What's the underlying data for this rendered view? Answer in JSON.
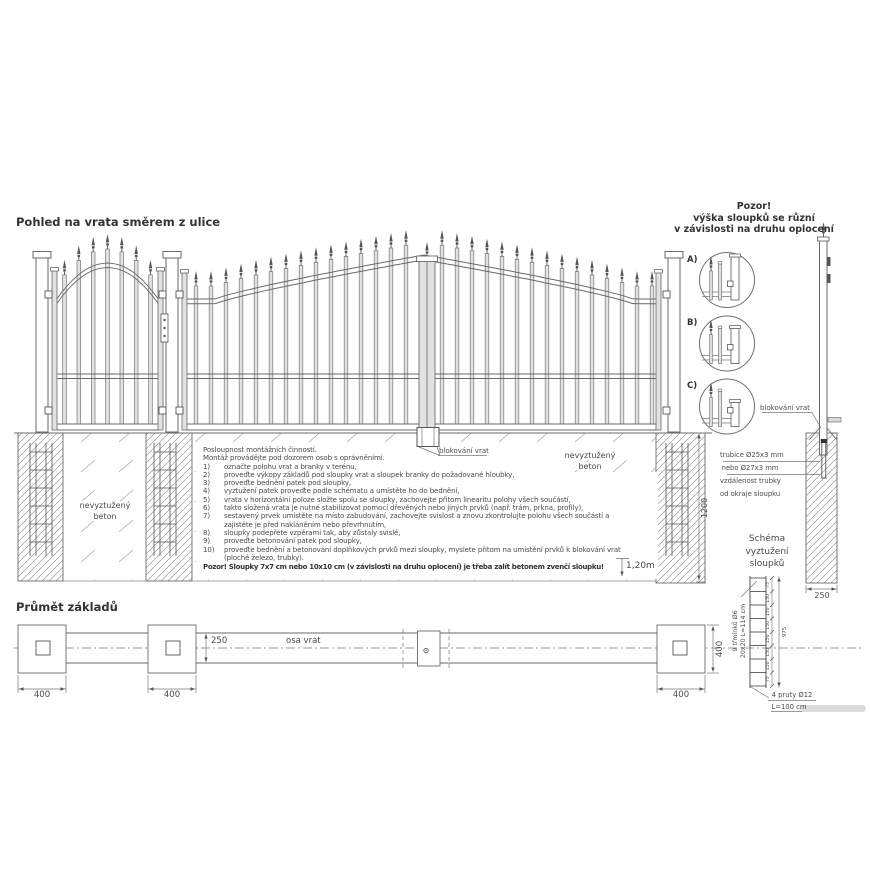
{
  "page": {
    "view_title": "Pohled na vrata směrem z ulice",
    "plan_title": "Průmět základů"
  },
  "notice_top_right": {
    "line1": "Pozor!",
    "line2": "výška sloupků se různí",
    "line3": "v závislosti na druhu oplocení"
  },
  "instructions": {
    "intro1": "Posloupnost montážních činností.",
    "intro2": "Montáž provádějte pod dozorem osob s oprávněními.",
    "steps": [
      {
        "num": "1)",
        "text": "označte polohu vrat a branky v terénu,"
      },
      {
        "num": "2)",
        "text": "proveďte výkopy základů pod sloupky vrat a sloupek branky do požadované hloubky,"
      },
      {
        "num": "3)",
        "text": "proveďte bednění patek pod sloupky,"
      },
      {
        "num": "4)",
        "text": "vyztužení patek proveďte podle schématu a umístěte ho do bednění,"
      },
      {
        "num": "5)",
        "text": "vrata v horizontální poloze složte spolu se sloupky, zachovejte přitom linearitu polohy všech součástí,"
      },
      {
        "num": "6)",
        "text": "takto složená vrata je nutné stabilizovat pomocí dřevěných nebo jiných prvků (např. trám, prkna, profily),"
      },
      {
        "num": "7)",
        "text": "sestavený prvek umístěte na místo zabudování, zachovejte svislost a znovu zkontrolujte polohu všech součástí a zajistěte je před nakláněním nebo převrhnutím,"
      },
      {
        "num": "8)",
        "text": "sloupky podepřete vzpěrami tak, aby zůstaly svislé,"
      },
      {
        "num": "9)",
        "text": "proveďte betonování patek pod sloupky,"
      },
      {
        "num": "10)",
        "text": "proveďte bednění a betonování doplňkových prvků mezi sloupky, myslete přitom na umístění prvků k blokování vrat (ploché železo, trubky)."
      }
    ],
    "warning": "Pozor! Sloupky 7x7 cm nebo 10x10 cm (v závislosti na druhu oplocení) je třeba zalít betonem zvenčí sloupku!"
  },
  "labels": {
    "unreinforced_line1": "nevyztužený",
    "unreinforced_line2": "beton",
    "gate_block": "blokování vrat",
    "depth": "1,20m",
    "dim_1200": "1200",
    "dim_250": "250",
    "tube_line1": "trubice Ø25x3 mm",
    "tube_line2": "nebo Ø27x3 mm",
    "tube_line3": "vzdálenost trubky",
    "tube_line4": "od okraje sloupku",
    "detail_a": "A)",
    "detail_b": "B)",
    "detail_c": "C)"
  },
  "schema": {
    "title_line1": "Schéma",
    "title_line2": "vyztužení",
    "title_line3": "sloupků",
    "stirrups_label": "9 třmínků Ø6",
    "stirrups_size": "20x20 L=114 cm",
    "rods_label": "4 pruty Ø12",
    "rods_length": "L=100 cm",
    "segment_dims": [
      "75",
      "150",
      "150",
      "150",
      "150",
      "150",
      "150",
      "75"
    ],
    "total_dim": "975"
  },
  "plan": {
    "axis_label": "osa vrat",
    "dim_250": "250",
    "dim_400_left": "400",
    "dim_400_mid": "400",
    "dim_400_right": "400",
    "dim_400_vert": "400"
  },
  "colors": {
    "line": "#6a6a6a",
    "dark": "#555555",
    "hatch": "#9a9a9a",
    "bar_fill": "#e2e2e2"
  }
}
